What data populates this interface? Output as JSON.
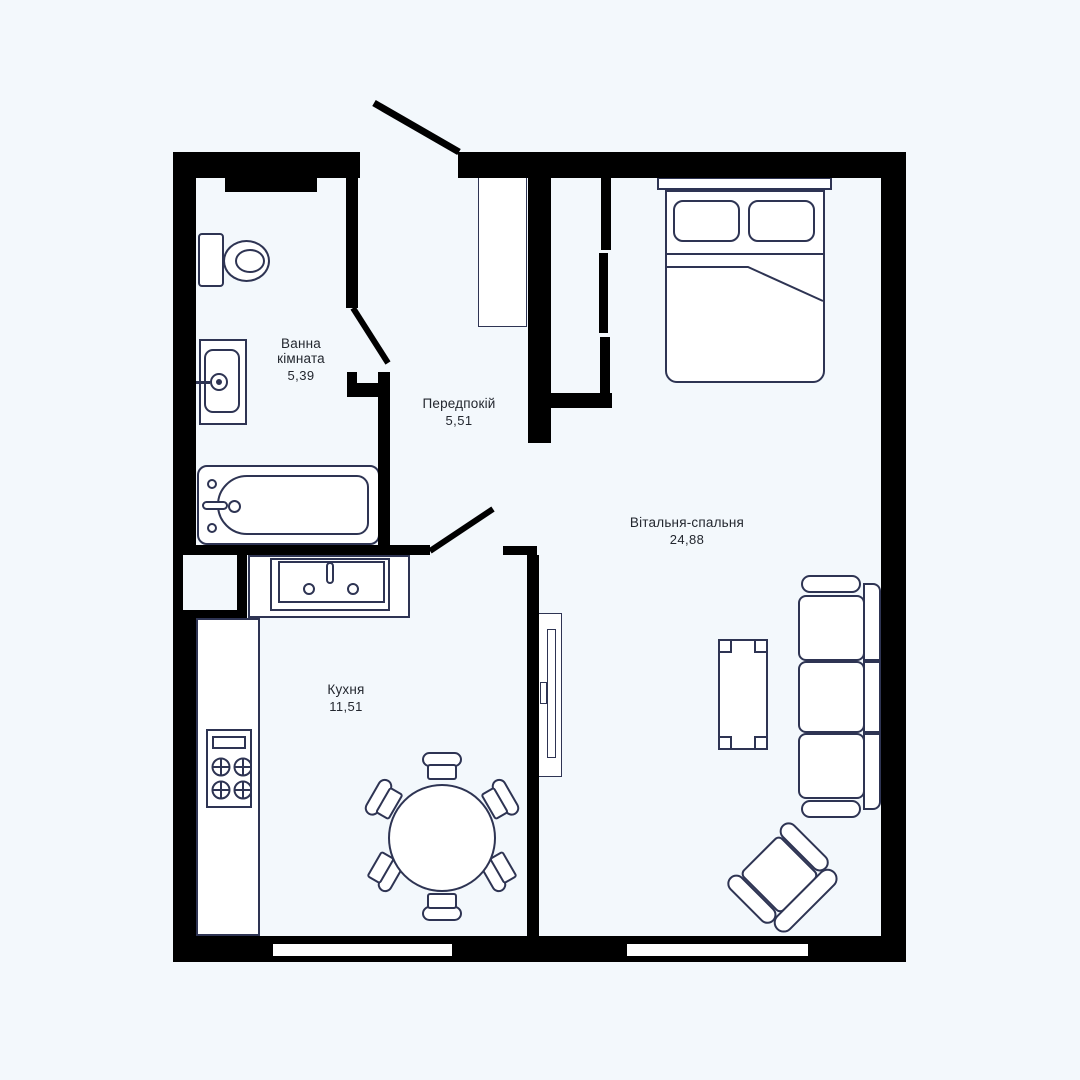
{
  "plan": {
    "colors": {
      "background": "#f3f8fc",
      "wall": "#000000",
      "furniture_outline": "#2e3453",
      "furniture_fill": "#ffffff",
      "label_text": "#23272f"
    },
    "rooms": [
      {
        "id": "bathroom",
        "name_line1": "Ванна",
        "name_line2": "кімната",
        "area": "5,39"
      },
      {
        "id": "hallway",
        "name": "Передпокій",
        "area": "5,51"
      },
      {
        "id": "kitchen",
        "name": "Кухня",
        "area": "11,51"
      },
      {
        "id": "living_bedroom",
        "name": "Вітальня-спальня",
        "area": "24,88"
      }
    ],
    "furniture_icons": [
      "toilet-icon",
      "washbasin-icon",
      "bathtub-icon",
      "ventilation-shaft-icon",
      "kitchen-sink-icon",
      "stove-icon",
      "kitchen-counter-icon",
      "dining-table-icon",
      "dining-chair-icon",
      "tv-icon",
      "coffee-table-icon",
      "sofa-icon",
      "armchair-icon",
      "double-bed-icon",
      "pillow-icon",
      "wardrobe-icon",
      "sliding-closet-icon",
      "entrance-door-icon",
      "interior-door-icon",
      "window-icon"
    ]
  }
}
